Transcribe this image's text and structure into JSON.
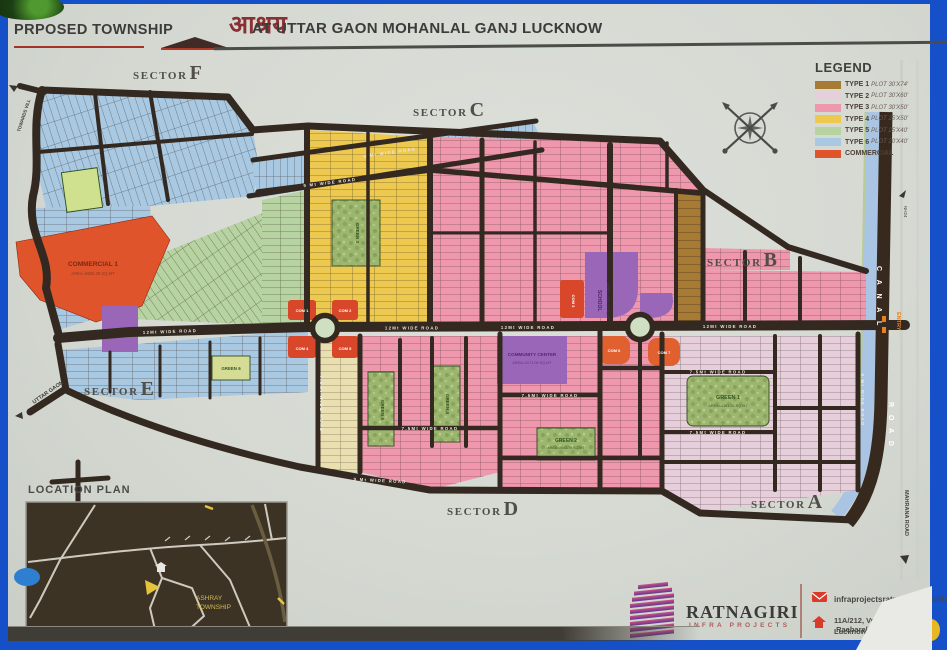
{
  "title": {
    "prefix": "PRPOSED TOWNSHIP",
    "logo_word": "आश्रय",
    "suffix": "AT UTTAR GAON MOHANLAL GANJ LUCKNOW"
  },
  "legend": {
    "heading": "LEGEND",
    "items": [
      {
        "label": "TYPE 1",
        "detail": "PLOT 30'X74'",
        "color": "#a87b34"
      },
      {
        "label": "TYPE 2",
        "detail": "PLOT 30'X60'",
        "color": "#e6cfda"
      },
      {
        "label": "TYPE 3",
        "detail": "PLOT 30'X50'",
        "color": "#ee97ad"
      },
      {
        "label": "TYPE 4",
        "detail": "PLOT 25'X50'",
        "color": "#eec94f"
      },
      {
        "label": "TYPE 5",
        "detail": "PLOT 25'X40'",
        "color": "#b7d3a2"
      },
      {
        "label": "TYPE 6",
        "detail": "PLOT 20'X40'",
        "color": "#a9c9e2"
      },
      {
        "label": "COMMERCIAL",
        "detail": "",
        "color": "#e0542c"
      }
    ]
  },
  "sectors": {
    "word": "SECTOR",
    "list": [
      "F",
      "C",
      "B",
      "E",
      "D",
      "A"
    ]
  },
  "map": {
    "commercial1": {
      "line1": "COMMERCIAL 1",
      "line2": "AREA=8605.38 SQ.MT"
    },
    "community_center": {
      "line1": "COMMUNITY CENTER",
      "line2": "AREA=2071.06 SQ.MT"
    },
    "school": {
      "line1": "SCHOOL",
      "line2": "AREA=2508.75 SQ.MT"
    },
    "com_blocks": [
      "COM 1",
      "COM 2",
      "COM 3",
      "COM 4",
      "COM 5",
      "COM 6",
      "COM 7"
    ],
    "greens": [
      {
        "name": "GREEN 1",
        "area": "AREA=4181.55 SQ.MT"
      },
      {
        "name": "GREEN 2",
        "area": "AREA=2043.79 SQ.MT"
      },
      {
        "name": "GREEN 3",
        "area": ""
      },
      {
        "name": "GREEN 4",
        "area": ""
      },
      {
        "name": "GREEN 5",
        "area": ""
      },
      {
        "name": "GREEN 6",
        "area": ""
      }
    ],
    "roads": {
      "main": "12Mt WIDE ROAD",
      "r9": "9 Mt WIDE ROAD",
      "r75": "7.5Mt WIDE ROAD"
    },
    "edges": {
      "canal": "C A N A L",
      "road": "R O A D",
      "entry": "ENTRY",
      "nh": "NH24",
      "mahrana": "MAHRANA ROAD",
      "uttar_gaon": "UTTAR GAON",
      "towards": "TOWARDS VILL"
    }
  },
  "location_plan": {
    "heading": "LOCATION PLAN",
    "marker_line1": "ASHRAY",
    "marker_line2": "TOWNSHIP"
  },
  "company": {
    "name": "RATNAGIRI",
    "subtitle": "INFRA PROJECTS",
    "email": "infraprojectsratnagiri@gmail.com",
    "address1": "11A/212, Vrindavan Yojna ,Raebareli Road,",
    "address2": "Lucknow 226025"
  },
  "colors": {
    "frame_blue": "#1550c8",
    "poster": "#d5d9d2",
    "road_dark": "#332921",
    "canal_blue": "#a9c5e3",
    "commercial_red": "#e0542c",
    "com_red": "#d9472b",
    "purple": "#9a67b8",
    "park_green": "#9cb56f",
    "roundabout": "#cfe0c2"
  }
}
